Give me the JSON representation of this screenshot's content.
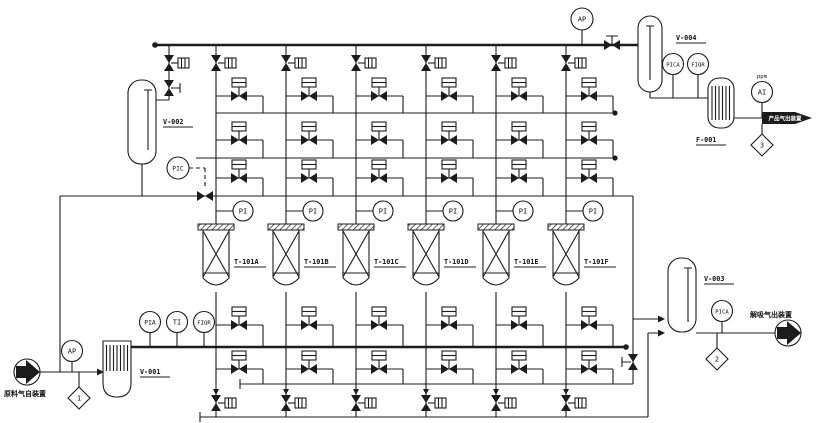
{
  "diagram": {
    "colors": {
      "line": "#1c1c1c",
      "background": "#ffffff"
    },
    "equipment": {
      "v001": "V-001",
      "v002": "V-002",
      "v003": "V-003",
      "v004": "V-004",
      "f001": "F-001",
      "adsorbers": [
        {
          "tag": "T-101A",
          "pi": "PI"
        },
        {
          "tag": "T-101B",
          "pi": "PI"
        },
        {
          "tag": "T-101C",
          "pi": "PI"
        },
        {
          "tag": "T-101D",
          "pi": "PI"
        },
        {
          "tag": "T-101E",
          "pi": "PI"
        },
        {
          "tag": "T-101F",
          "pi": "PI"
        }
      ]
    },
    "instruments": {
      "ap_top": "AP",
      "ap_feed": "AP",
      "pic": "PIC",
      "pia": "PIA",
      "ti": "TI",
      "fiqr_feed": "FIQR",
      "pica_v004": "PICA",
      "fiqr_v004": "FIQR",
      "ai": "AI",
      "ai_note": "ppm",
      "pica_v003": "PICA"
    },
    "tiepoints": {
      "d1": "1",
      "d2": "2",
      "d3": "3"
    },
    "streams": {
      "inlet": "原料气自装置",
      "outlet_product": "产品气出装置",
      "outlet_offgas": "解吸气出装置"
    }
  }
}
